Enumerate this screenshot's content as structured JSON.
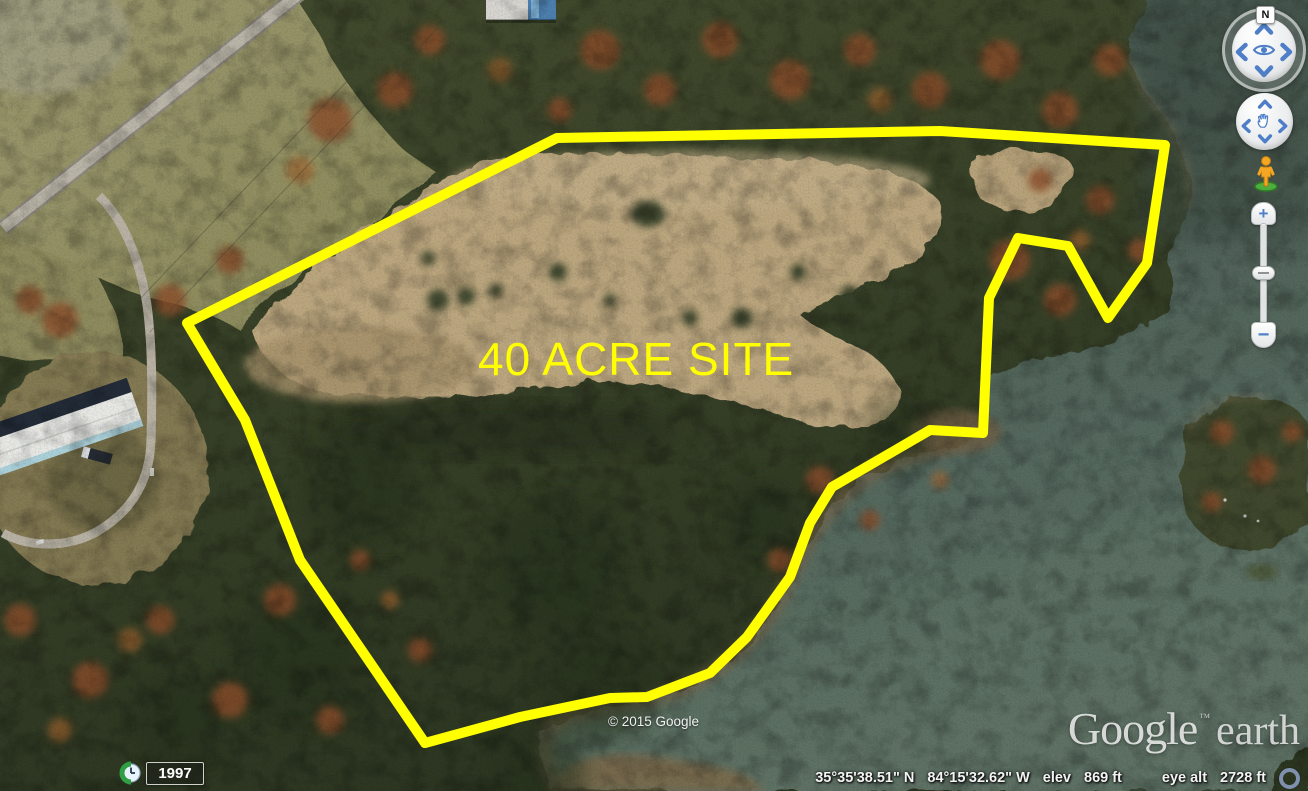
{
  "app": {
    "name": "Google Earth"
  },
  "map": {
    "site_label": {
      "text": "40 ACRE SITE",
      "color": "#ffff00"
    },
    "polygon": {
      "color": "#ffff00",
      "stroke_width": 10,
      "points": "187,323 557,138 940,131 1165,145 1147,263 1108,318 1068,246 1018,238 989,298 983,433 930,430 832,487 810,523 790,577 747,637 710,673 647,697 610,698 520,717 425,743 300,560 245,420"
    },
    "colors": {
      "water_dark": "#45544b",
      "water_light": "#5e7265",
      "shallow_brown": "#7a684c",
      "field_tan": "#bca77f",
      "grass_olive": "#94905f",
      "forest_dark": "#2f3a24",
      "forest_mid": "#41492c",
      "autumn_orange": "#8a4e2b",
      "road_gray": "#b6b1a5"
    }
  },
  "navigation": {
    "north_label": "N",
    "look_control": {
      "icon": "eye-icon",
      "arrows": [
        "up",
        "right",
        "down",
        "left"
      ]
    },
    "move_control": {
      "icon": "pan-hand-icon",
      "arrows": [
        "up",
        "right",
        "down",
        "left"
      ]
    },
    "pegman": "street-view-pegman-icon",
    "zoom": {
      "zoom_in": "+",
      "zoom_out": "−"
    }
  },
  "time_control": {
    "icon": "clock-icon",
    "year": "1997"
  },
  "attribution": {
    "copyright": "© 2015 Google",
    "logo_google": "Google",
    "logo_tm": "™",
    "logo_earth": "earth"
  },
  "status_bar": {
    "latitude": "35°35'38.51\" N",
    "longitude": "84°15'32.62\" W",
    "elev_label": "elev",
    "elev_value": "869 ft",
    "eye_alt_label": "eye alt",
    "eye_alt_value": "2728 ft",
    "streaming_icon": "streaming-progress-ring"
  }
}
